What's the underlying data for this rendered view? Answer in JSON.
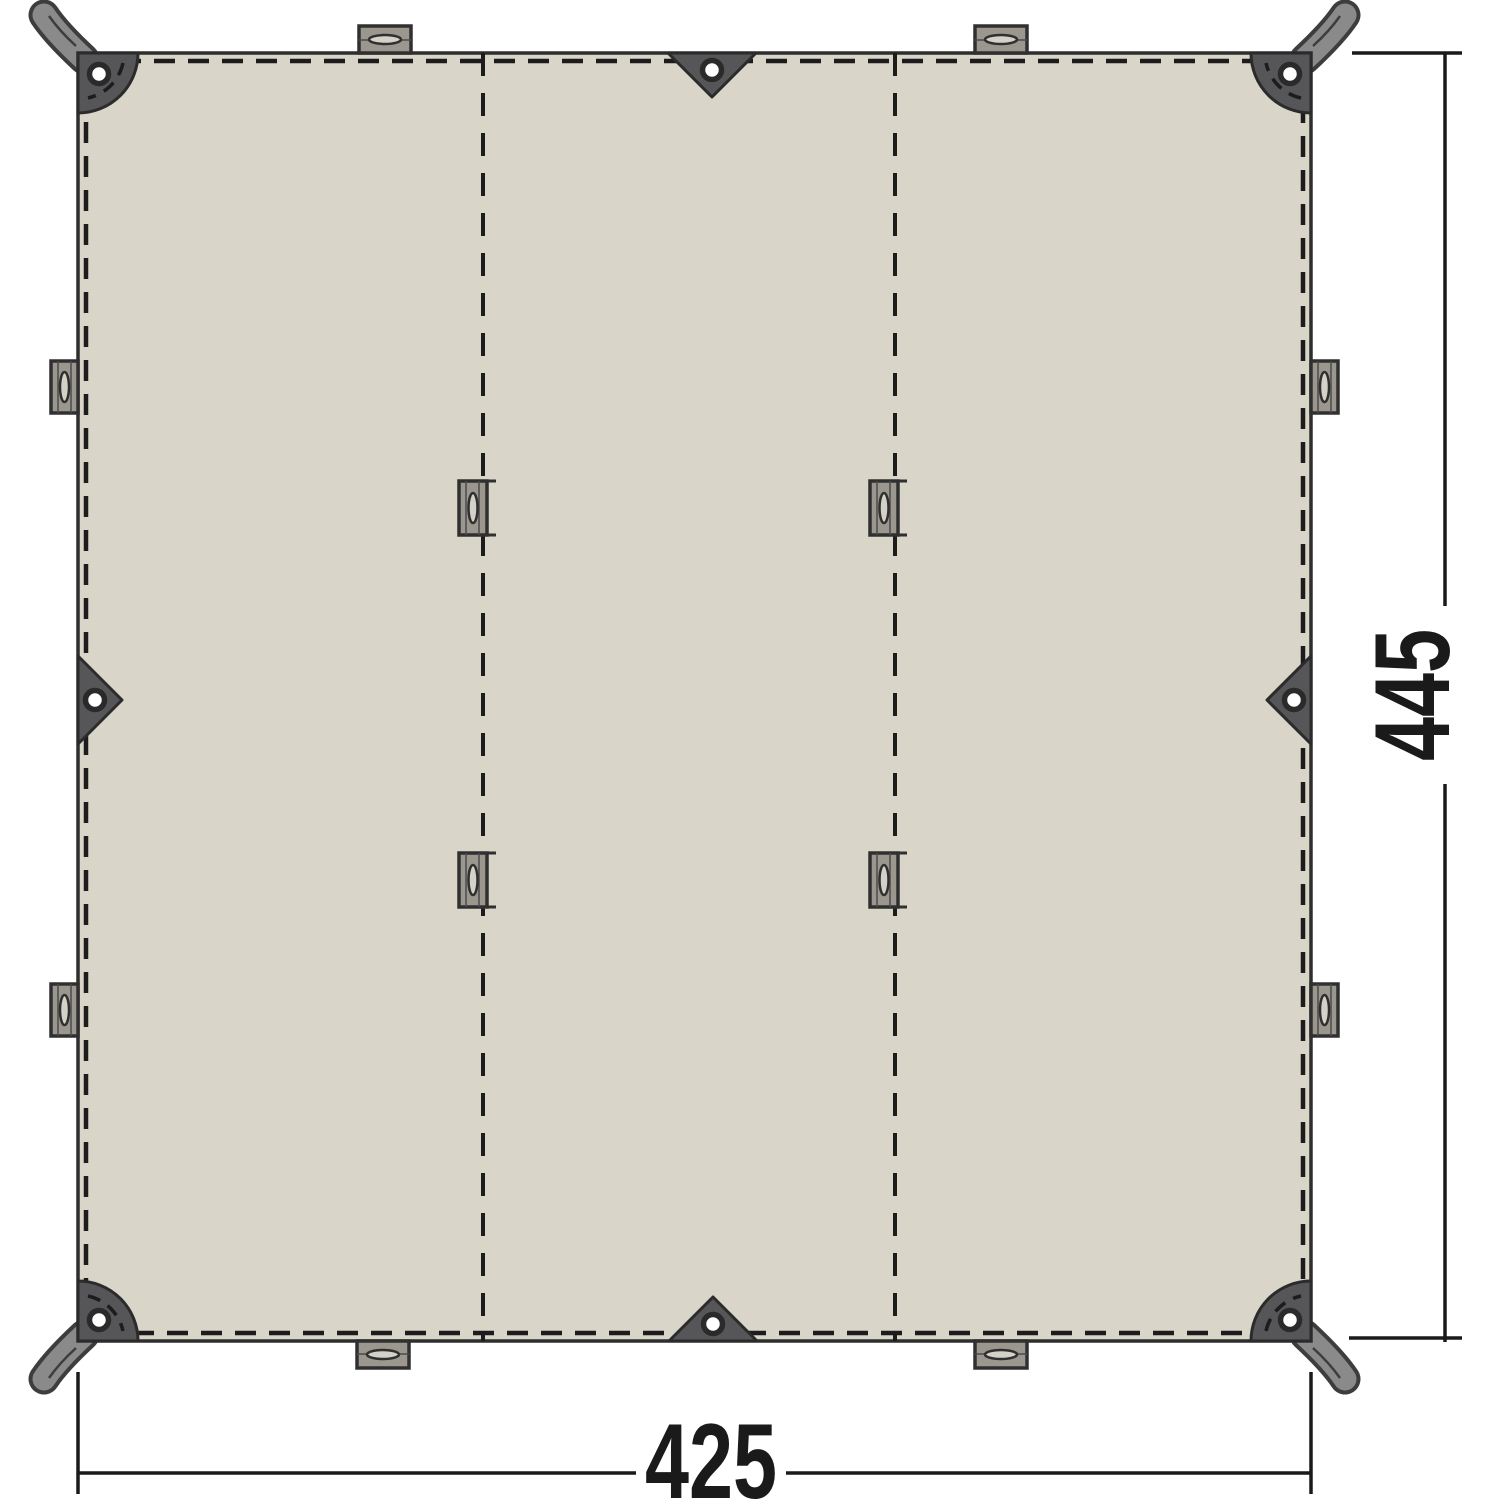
{
  "diagram": {
    "type": "tarp-top-view",
    "description": "Top view diagram of a rectangular tarp with corner straps, grommeted corner and mid-edge anchor patches, webbing tabs along the edges and on two fold seams, annotated with its width and height dimensions."
  },
  "dimensions": {
    "width_label": "425",
    "height_label": "445"
  },
  "features": {
    "corner_straps": 4,
    "corner_patches": 4,
    "corner_grommets": 4,
    "edge_triangle_anchors": 4,
    "edge_webbing_tabs": 8,
    "seam_webbing_tabs": 4,
    "fold_seams": 2
  },
  "colors": {
    "background": "#ffffff",
    "fabric": "#d9d5c9",
    "outline": "#2e2e2e",
    "stitch": "#1c1c1c",
    "patch": "#565659",
    "patch-stroke": "#2b2b2b",
    "strap": "#8a8a8a",
    "strap-outline": "#3d3d3d",
    "tab": "#9b978f",
    "tab-stroke": "#303030",
    "slot": "#d4d1c8",
    "grommet-ring": "#2a2a2a",
    "dim": "#1a1a1a"
  }
}
